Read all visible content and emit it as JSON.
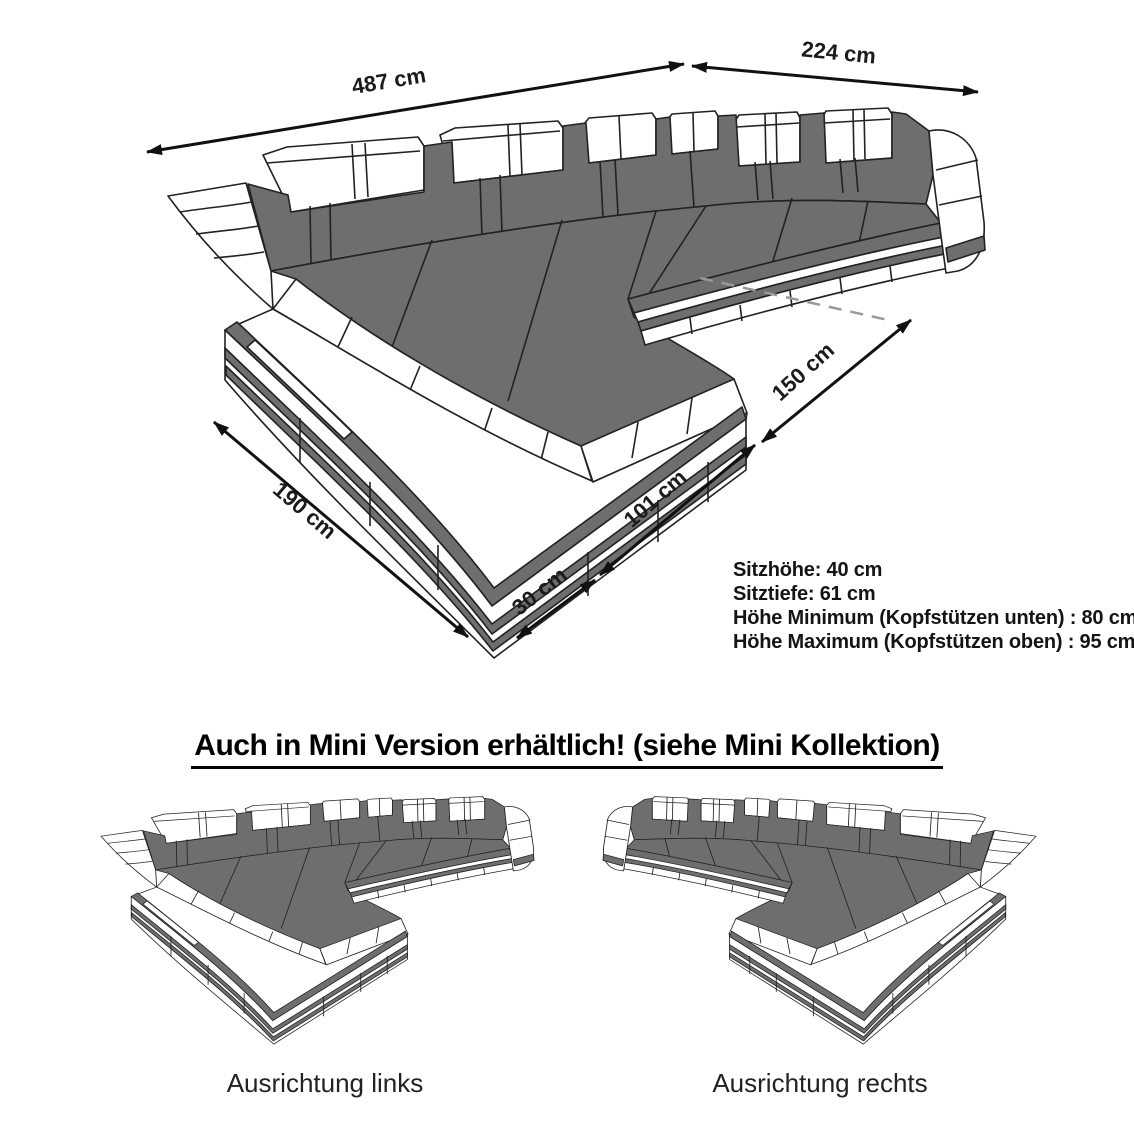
{
  "figure": {
    "dimensions": {
      "back_width": "487 cm",
      "right_width": "224 cm",
      "left_depth": "190 cm",
      "corner_width": "30 cm",
      "front_width": "101 cm",
      "right_depth": "150 cm"
    },
    "specs": [
      "Sitzhöhe: 40 cm",
      "Sitztiefe: 61 cm",
      "Höhe Minimum (Kopfstützen unten) : 80 cm",
      "Höhe Maximum (Kopfstützen oben) : 95 cm"
    ]
  },
  "mini_section": {
    "heading": "Auch in Mini Version erhältlich! (siehe Mini Kollektion)",
    "labels": [
      "Ausrichtung links",
      "Ausrichtung rechts"
    ]
  },
  "colors": {
    "upholstery_gray": "#6e6e6e",
    "outline": "#222222",
    "arrow": "#111111",
    "dashed_line": "#999999",
    "background": "#ffffff"
  }
}
